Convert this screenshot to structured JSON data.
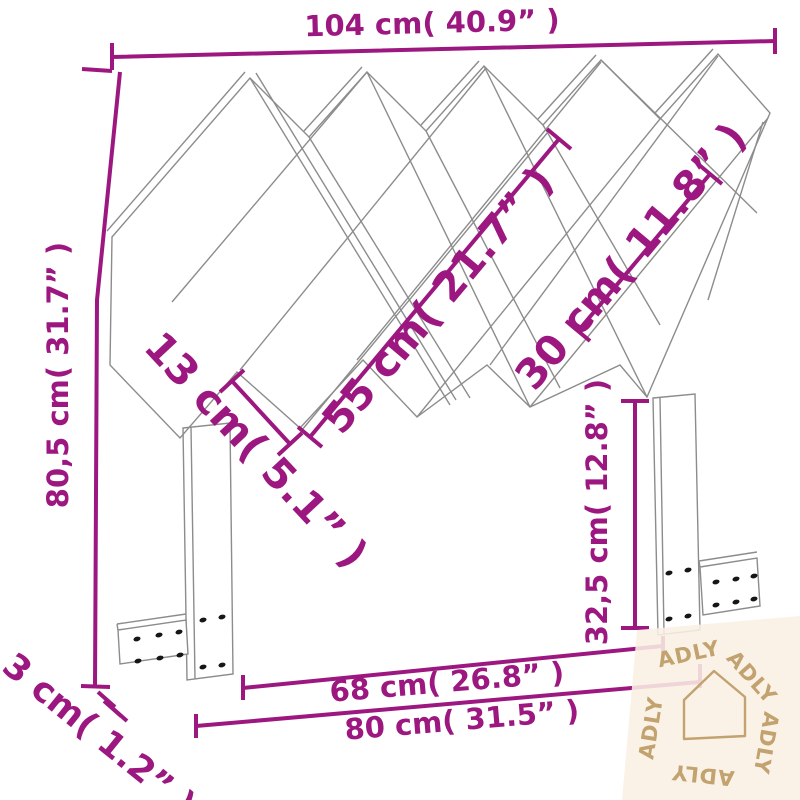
{
  "colors": {
    "dimension_line": "#9c1780",
    "drawing_line": "#8c8c8c",
    "screw_hole": "#161616",
    "watermark_text": "#c2a26e",
    "watermark_background": "#faf0e4",
    "background": "#ffffff"
  },
  "dimensions": {
    "top_width": {
      "label": "104 cm( 40.9” )"
    },
    "height": {
      "label": "80,5 cm( 31.7” )"
    },
    "slat_long": {
      "label": "55 cm( 21.7” )"
    },
    "slat_short": {
      "label": "30 cm( 11.8” )"
    },
    "slat_width": {
      "label": "13 cm( 5.1” )"
    },
    "leg_height": {
      "label": "32,5 cm( 12.8” )"
    },
    "inner_width": {
      "label": "68 cm( 26.8” )"
    },
    "outer_width": {
      "label": "80 cm( 31.5” )"
    },
    "thickness": {
      "label": "3 cm( 1.2” )"
    }
  },
  "watermark": {
    "brand": "ADLY"
  }
}
